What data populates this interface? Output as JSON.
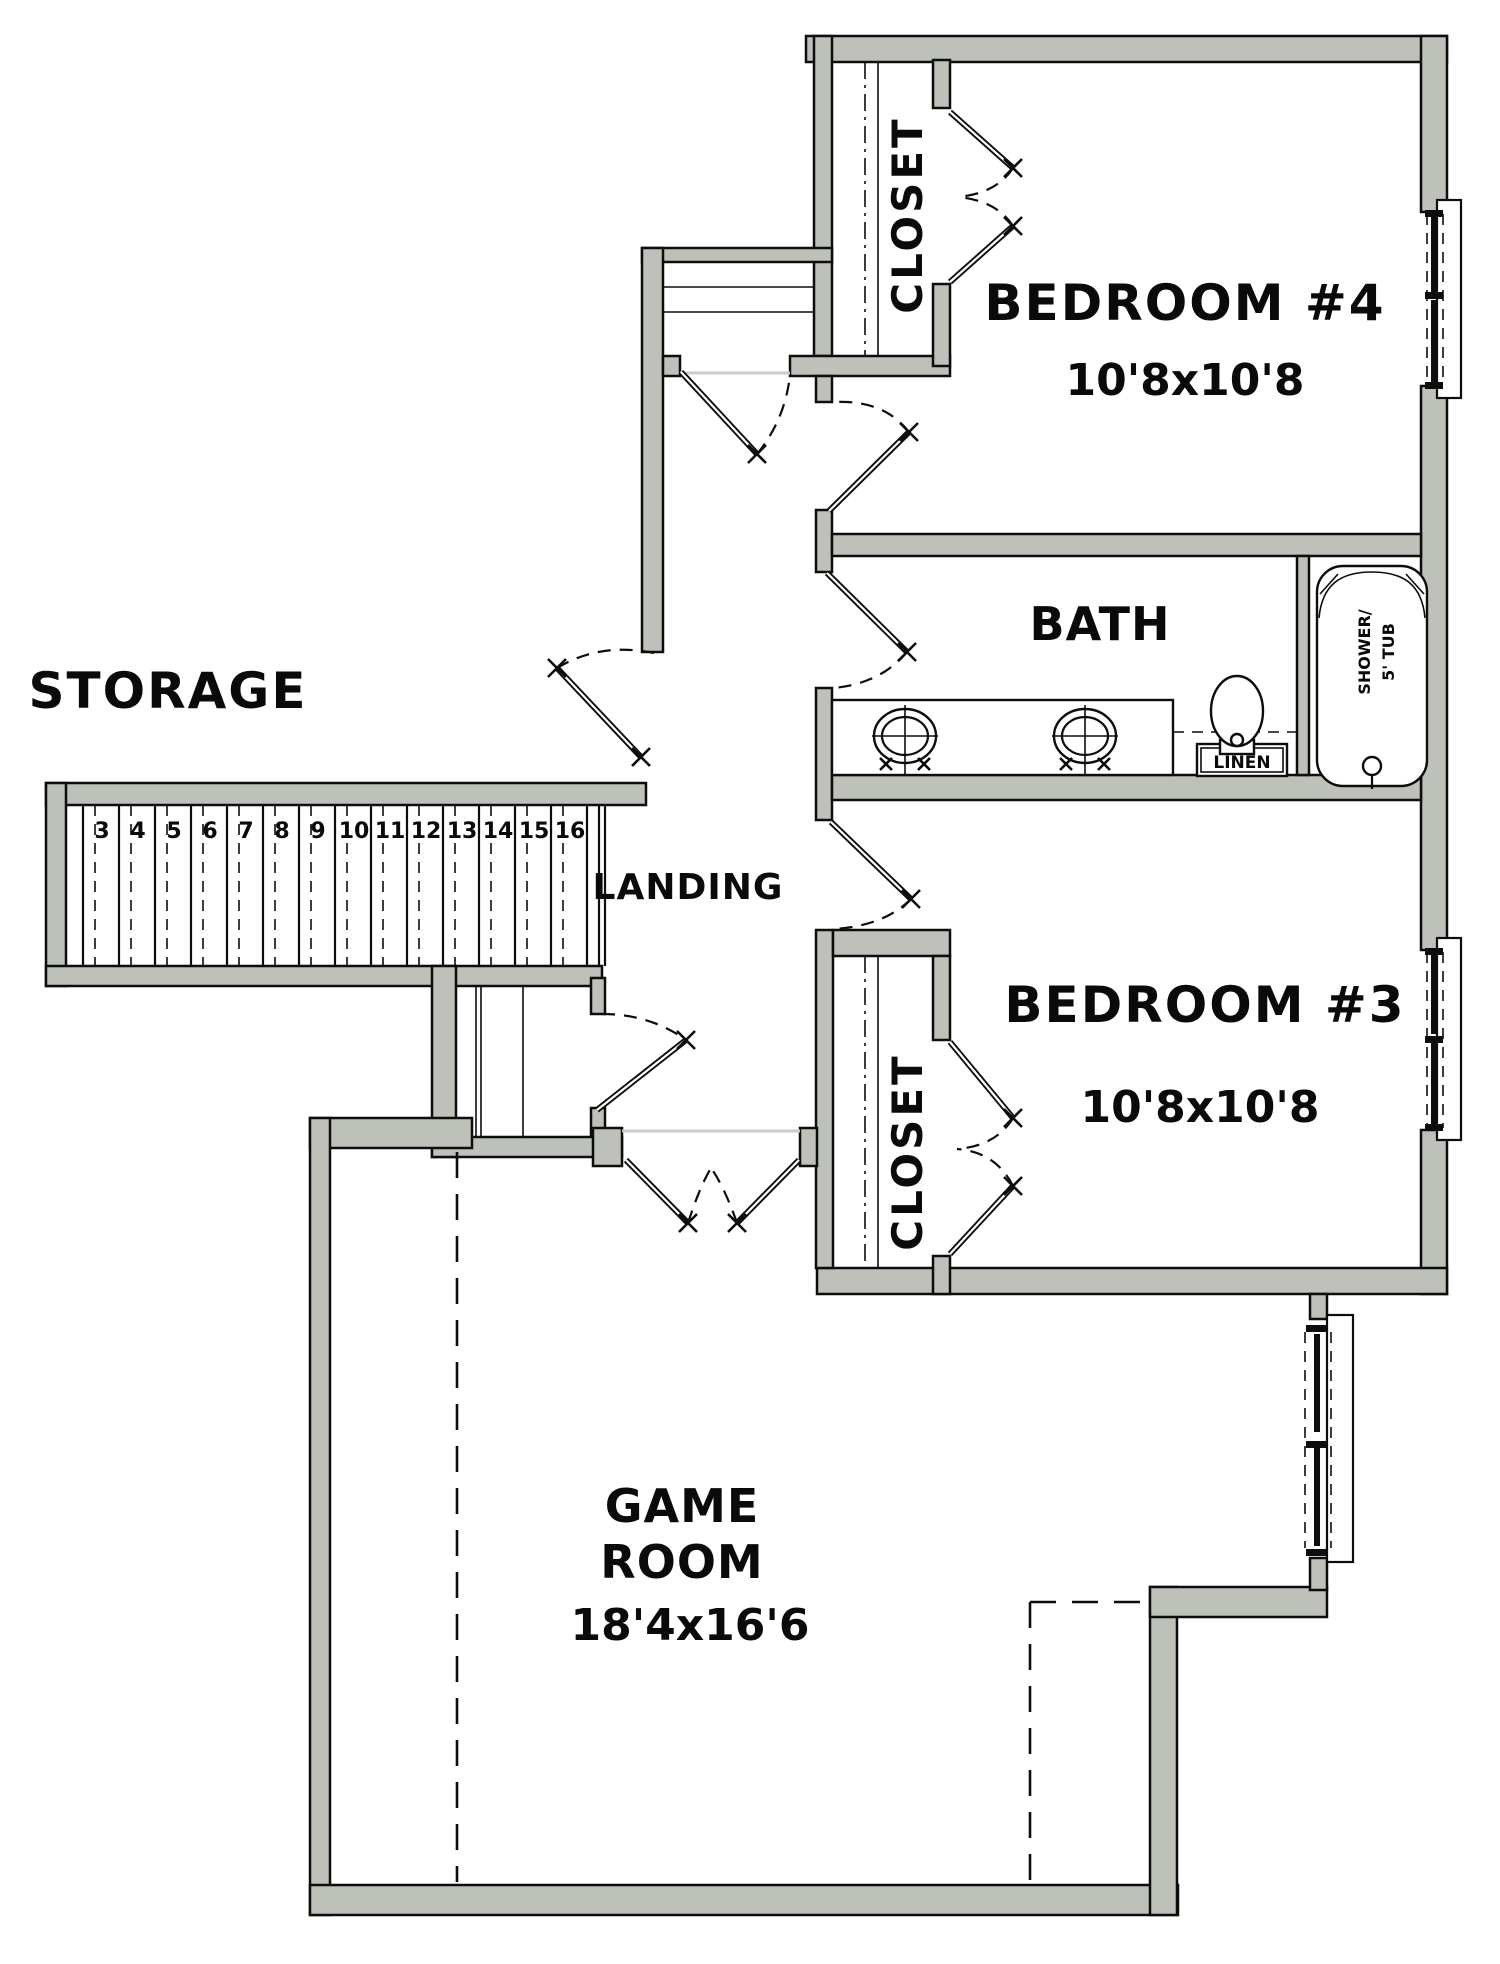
{
  "plan": {
    "rooms": {
      "storage": {
        "label": "STORAGE"
      },
      "landing": {
        "label": "LANDING"
      },
      "bath": {
        "label": "BATH"
      },
      "bedroom4": {
        "label": "BEDROOM #4",
        "dimensions": "10'8x10'8"
      },
      "bedroom3": {
        "label": "BEDROOM #3",
        "dimensions": "10'8x10'8"
      },
      "game_room": {
        "label_line1": "GAME",
        "label_line2": "ROOM",
        "dimensions": "18'4x16'6"
      },
      "bedroom4_closet": {
        "label": "CLOSET"
      },
      "bedroom3_closet": {
        "label": "CLOSET"
      }
    },
    "fixtures": {
      "linen_cabinet": {
        "label": "LINEN"
      },
      "tub": {
        "label_line1": "SHOWER/",
        "label_line2": "5' TUB"
      }
    },
    "stairs": {
      "treads": [
        "3",
        "4",
        "5",
        "6",
        "7",
        "8",
        "9",
        "10",
        "11",
        "12",
        "13",
        "14",
        "15",
        "16"
      ]
    },
    "colors": {
      "wall_fill": "#bdc1b9",
      "line": "#0d0d0d",
      "threshold": "#c9cdc6",
      "background": "#ffffff"
    }
  }
}
